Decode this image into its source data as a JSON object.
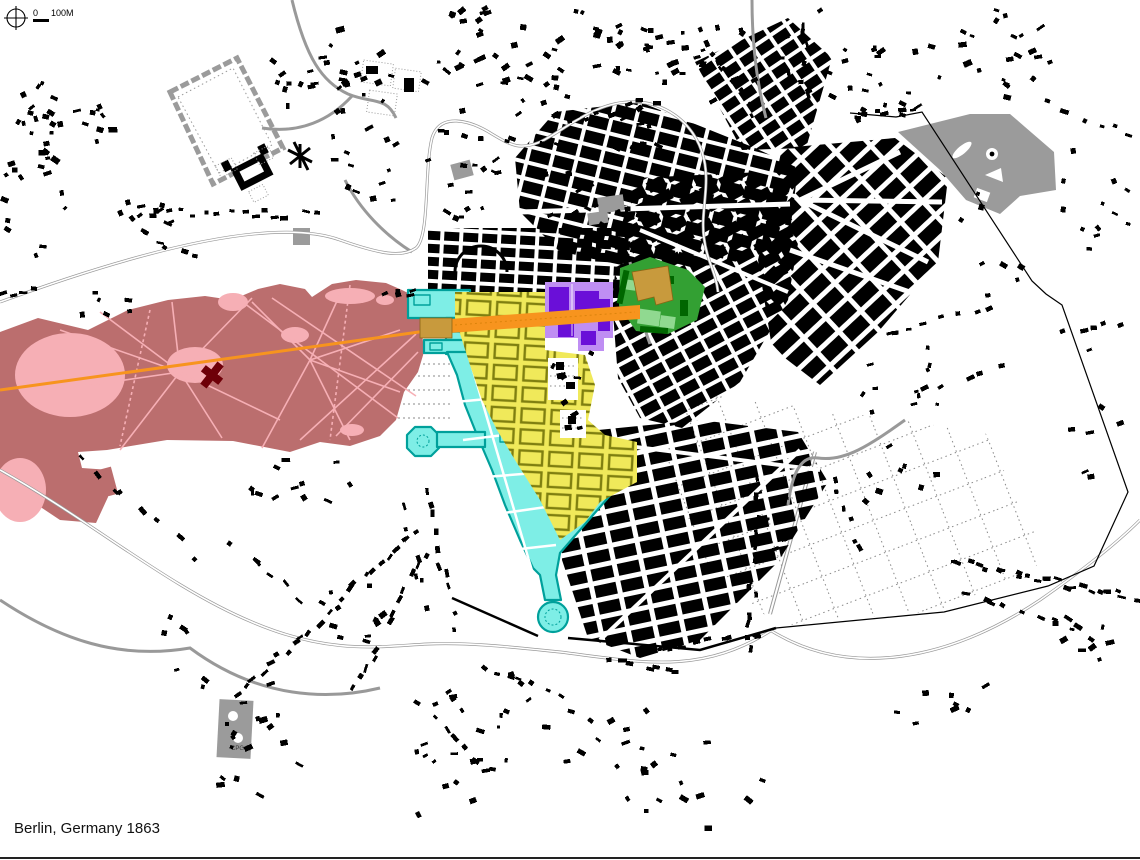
{
  "page": {
    "caption": "Berlin, Germany 1863"
  },
  "scalebar": {
    "zero_label": "0",
    "distance_label": "100M"
  },
  "labels": {
    "cemetery": "CPG"
  },
  "colors": {
    "rose": "#BB6E6E",
    "pink": "#F6AFB5",
    "maroon": "#6E0008",
    "orange": "#F7941E",
    "tan": "#C89A3D",
    "yellow": "#F0E95A",
    "olive": "#7F7F10",
    "cyan": "#7EEEE6",
    "teal": "#00A09B",
    "purple-light": "#BF8EF3",
    "purple-dark": "#6A0FD8",
    "green-mid": "#33A033",
    "green-light": "#90D990",
    "green-dark": "#006600",
    "gray-park": "#9B9B9B",
    "road": "#999999",
    "black": "#000000"
  },
  "zones": [
    {
      "id": "large-park-west",
      "color_key": "rose"
    },
    {
      "id": "park-water-and-paths",
      "color_key": "pink"
    },
    {
      "id": "monument-building",
      "color_key": "maroon"
    },
    {
      "id": "central-axis",
      "color_key": "orange"
    },
    {
      "id": "axis-gate-plaza-and-palace",
      "color_key": "tan"
    },
    {
      "id": "baroque-grid-district",
      "color_key": "yellow"
    },
    {
      "id": "wall-ring-district-and-gate-plazas",
      "color_key": "cyan"
    },
    {
      "id": "forum-district",
      "color_key": "purple-light"
    },
    {
      "id": "palace-garden-district",
      "color_key": "green-mid"
    },
    {
      "id": "walled-park-northwest",
      "color_key": "gray-park"
    },
    {
      "id": "park-northeast",
      "color_key": "gray-park"
    },
    {
      "id": "cemetery-southwest",
      "color_key": "gray-park"
    },
    {
      "id": "building-fabric",
      "color_key": "black"
    },
    {
      "id": "roads-and-rivers",
      "color_key": "road"
    }
  ]
}
